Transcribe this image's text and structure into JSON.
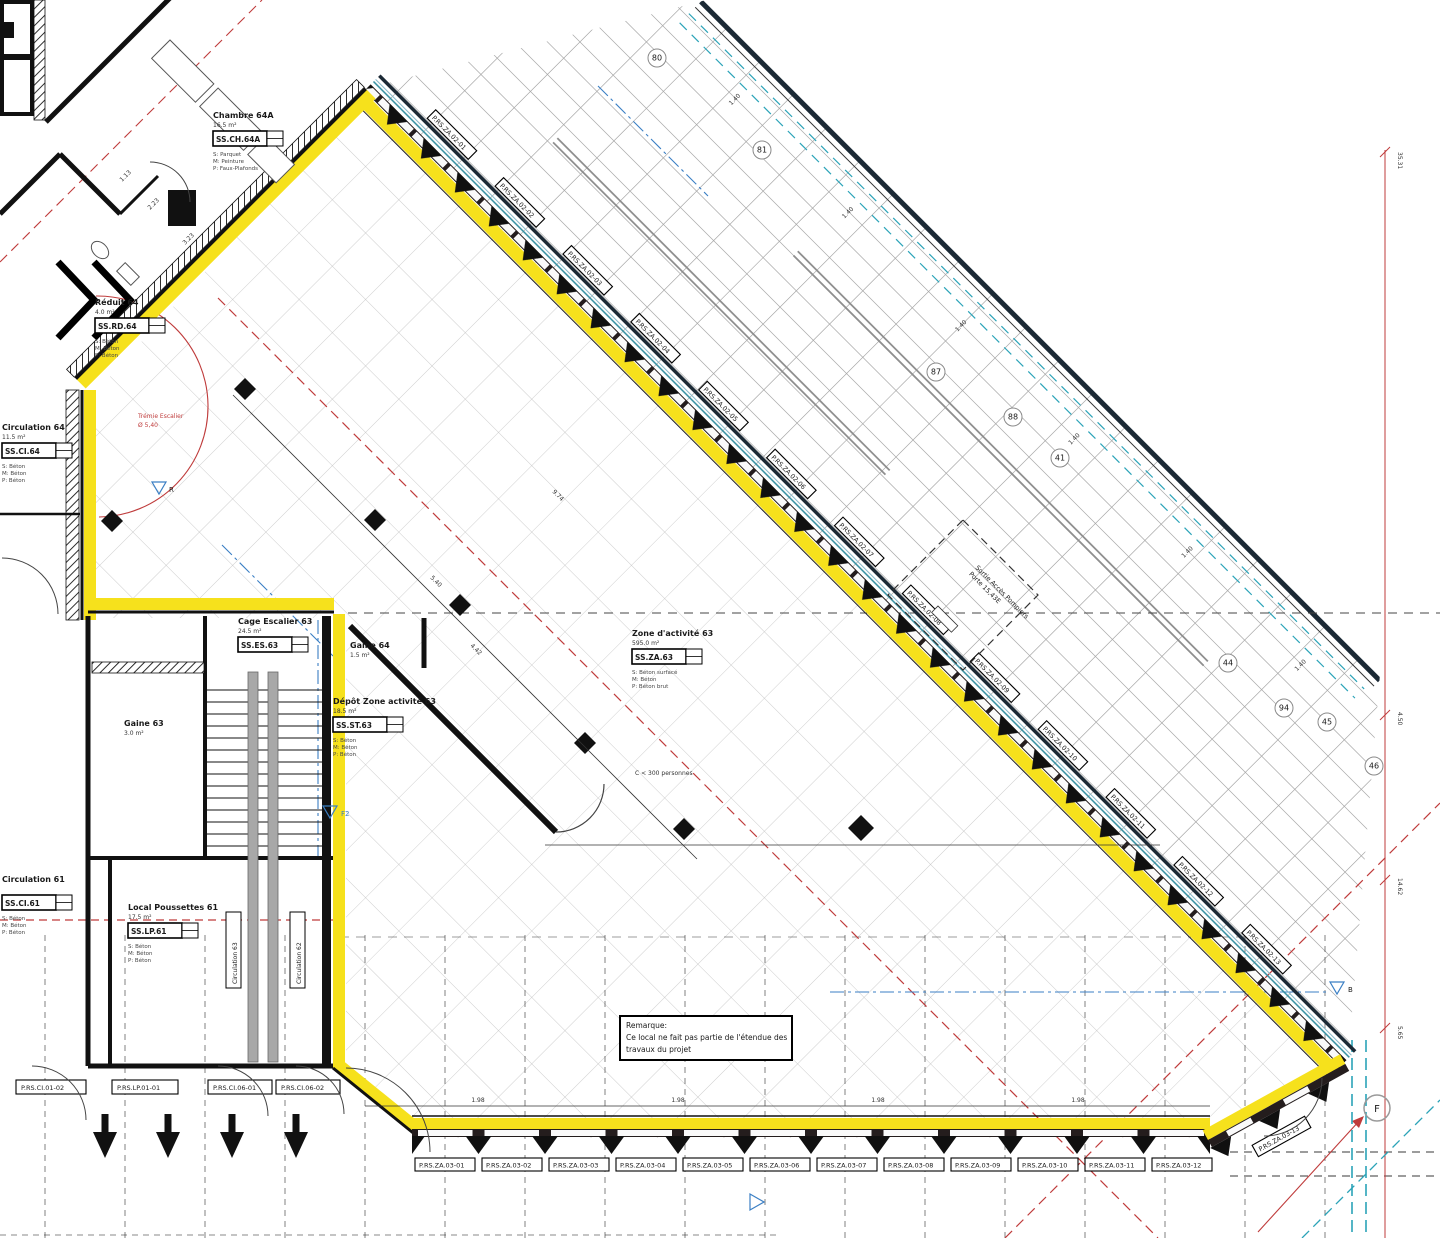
{
  "rooms": {
    "chambre64a": {
      "name": "Chambre 64A",
      "area": "16.5 m²",
      "tag": "SS.CH.64A",
      "finishes": [
        "S: Parquet",
        "M: Peinture",
        "P: Faux-Plafonds"
      ]
    },
    "reduit64": {
      "name": "Réduit 64",
      "area": "4.0 m²",
      "tag": "SS.RD.64",
      "finishes": [
        "S: Béton",
        "M: Béton",
        "P: Béton"
      ]
    },
    "circulation64": {
      "name": "Circulation 64",
      "area": "11.5 m²",
      "tag": "SS.CI.64",
      "finishes": [
        "S: Béton",
        "M: Béton",
        "P: Béton"
      ]
    },
    "zone63": {
      "name": "Zone d'activité 63",
      "area": "595.0 m²",
      "tag": "SS.ZA.63",
      "finishes": [
        "S: Béton surfacé",
        "M: Béton",
        "P: Béton brut"
      ]
    },
    "cage63": {
      "name": "Cage Escalier 63",
      "area": "24.5 m²",
      "tag": "SS.ES.63"
    },
    "gaine64": {
      "name": "Gaine 64",
      "area": "1.5 m²"
    },
    "gaine63": {
      "name": "Gaine 63",
      "area": "3.0 m²"
    },
    "depot63": {
      "name": "Dépôt Zone activité 63",
      "area": "18.5 m²",
      "tag": "SS.ST.63",
      "finishes": [
        "S: Béton",
        "M: Béton",
        "P: Béton"
      ]
    },
    "circulation61": {
      "name": "Circulation 61",
      "area": "13.0 m²",
      "tag": "SS.CI.61",
      "finishes": [
        "S: Béton",
        "M: Béton",
        "P: Béton"
      ]
    },
    "poussettes61": {
      "name": "Local Poussettes 61",
      "area": "17.5 m²",
      "tag": "SS.LP.61",
      "finishes": [
        "S: Béton",
        "M: Béton",
        "P: Béton"
      ]
    },
    "circulation63v": {
      "name": "Circulation 63"
    },
    "circulation62v": {
      "name": "Circulation 62"
    }
  },
  "notes": {
    "remark": [
      "Remarque:",
      "Ce local ne fait pas partie de l'étendue des",
      "travaux du projet"
    ]
  },
  "annotations": {
    "tremie_line1": "Trémie Escalier",
    "tremie_line2": "Ø 5,40",
    "sortie_line1": "Sortie Accès Pompiers",
    "sortie_line2": "Porte 15,43E",
    "capacity": "C < 300 personnes"
  },
  "markers": {
    "f": "F",
    "b": "B",
    "f2": "F2",
    "r": "R"
  },
  "grid_bubbles": [
    "80",
    "81",
    "87",
    "88",
    "41",
    "44",
    "94",
    "45",
    "46"
  ],
  "window_tags_diagonal": [
    "P.RS.ZA.02-01",
    "P.RS.ZA.02-02",
    "P.RS.ZA.02-03",
    "P.RS.ZA.02-04",
    "P.RS.ZA.02-05",
    "P.RS.ZA.02-06",
    "P.RS.ZA.02-07",
    "P.RS.ZA.02-08",
    "P.RS.ZA.02-09",
    "P.RS.ZA.02-10",
    "P.RS.ZA.02-11",
    "P.RS.ZA.02-12",
    "P.RS.ZA.02-13"
  ],
  "window_tags_bottom": [
    "P.RS.ZA.03-01",
    "P.RS.ZA.03-02",
    "P.RS.ZA.03-03",
    "P.RS.ZA.03-04",
    "P.RS.ZA.03-05",
    "P.RS.ZA.03-06",
    "P.RS.ZA.03-07",
    "P.RS.ZA.03-08",
    "P.RS.ZA.03-09",
    "P.RS.ZA.03-10",
    "P.RS.ZA.03-11",
    "P.RS.ZA.03-12"
  ],
  "window_tag_corner": "P.RS.ZA.03-13",
  "door_tags": [
    "P.RS.CI.01-02",
    "P.RS.LP.01-01",
    "P.RS.CI.06-01",
    "P.RS.CI.06-02"
  ],
  "dims": {
    "spacing": "1.40",
    "bottom": "1.98",
    "right_edge": [
      "35.31",
      "4.50",
      "14.62",
      "5.65"
    ],
    "hall": [
      "9.74",
      "5.40",
      "3.23",
      "2.23",
      "1.13",
      "4.42"
    ]
  }
}
